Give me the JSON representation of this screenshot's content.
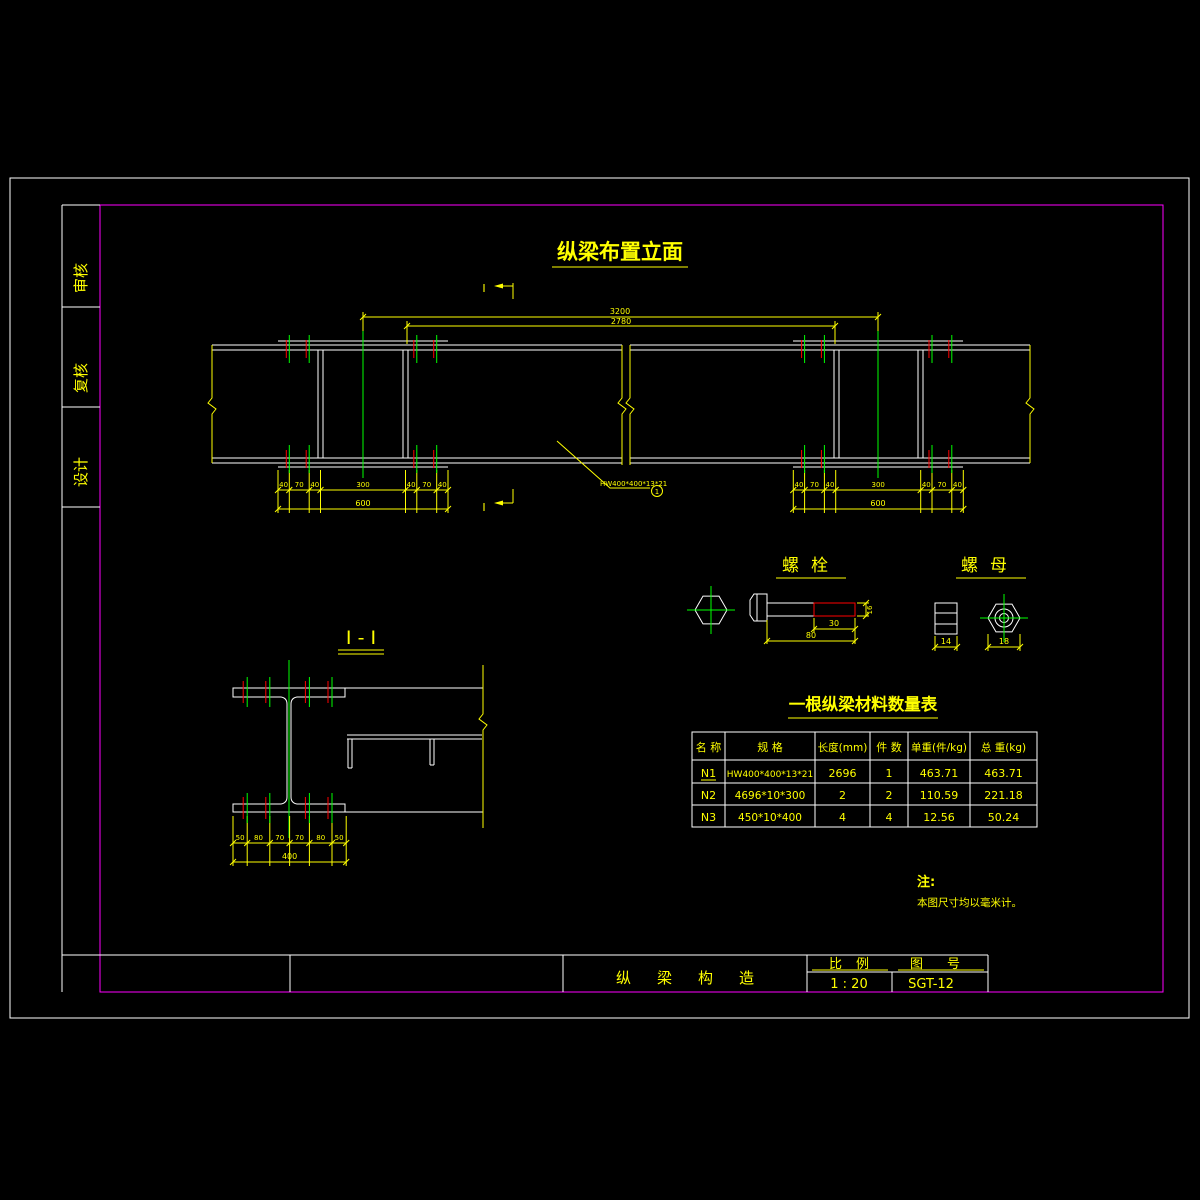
{
  "colors": {
    "background": "#000000",
    "line": "#ffffff",
    "annotation": "#ffff00",
    "centerline": "#00ff00",
    "highlight": "#ff0000",
    "border": "#ff00ff"
  },
  "sidebar": {
    "items": [
      {
        "label": "审核"
      },
      {
        "label": "复核"
      },
      {
        "label": "设计"
      }
    ]
  },
  "elevation": {
    "title": "纵梁布置立面",
    "dim_overall": "3200",
    "dim_inner": "2780",
    "left_dims": [
      "40",
      "70",
      "40",
      "300",
      "40",
      "70",
      "40"
    ],
    "left_total": "600",
    "right_dims": [
      "40",
      "70",
      "40",
      "300",
      "40",
      "70",
      "40"
    ],
    "right_total": "600",
    "section_label_top": "I",
    "section_label_bottom": "I",
    "leader_label": "HW400*400*13*21",
    "leader_bubble": "1"
  },
  "section": {
    "title": "I - I",
    "dims": [
      "50",
      "80",
      "70",
      "70",
      "80",
      "50"
    ],
    "total": "400"
  },
  "bolt": {
    "title": "螺栓",
    "dim_thread": "30",
    "dim_length": "80",
    "dim_dia": "16"
  },
  "nut": {
    "title": "螺母",
    "dim_height": "14",
    "dim_width": "18"
  },
  "material_table": {
    "title": "一根纵梁材料数量表",
    "headers": [
      "名 称",
      "规 格",
      "长度(mm)",
      "件 数",
      "单重(件/kg)",
      "总 重(kg)"
    ],
    "rows": [
      {
        "name": "N1",
        "spec": "HW400*400*13*21",
        "length": "2696",
        "count": "1",
        "unit_weight": "463.71",
        "total_weight": "463.71"
      },
      {
        "name": "N2",
        "spec": "4696*10*300",
        "length": "2",
        "count": "2",
        "unit_weight": "110.59",
        "total_weight": "221.18"
      },
      {
        "name": "N3",
        "spec": "450*10*400",
        "length": "4",
        "count": "4",
        "unit_weight": "12.56",
        "total_weight": "50.24"
      }
    ]
  },
  "note": {
    "label": "注:",
    "text": "本图尺寸均以毫米计。"
  },
  "title_block": {
    "drawing_name": "纵梁构造",
    "scale_label": "比例",
    "scale_value": "1 : 20",
    "number_label": "图号",
    "number_value": "SGT-12"
  }
}
